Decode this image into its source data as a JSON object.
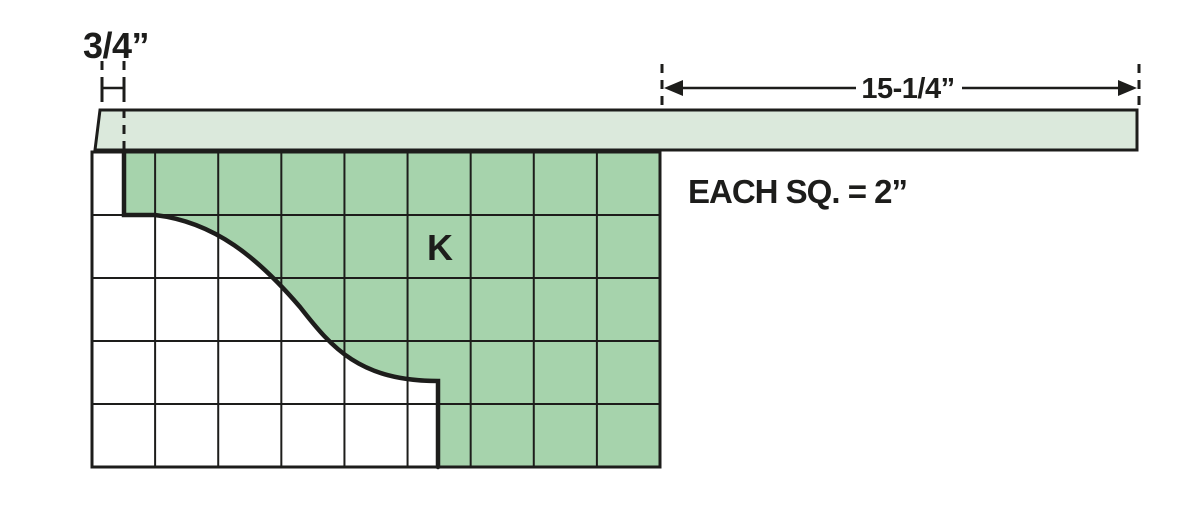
{
  "diagram": {
    "labels": {
      "offset_dim": "3/4”",
      "length_dim": "15-1/4”",
      "scale_note": "EACH SQ. = 2”",
      "piece": "K"
    },
    "grid": {
      "cols": 9,
      "rows": 5
    },
    "colors": {
      "rail_fill": "#dbe9dc",
      "piece_fill": "#a6d3ac",
      "line": "#1d1d1b",
      "background": "#ffffff"
    }
  }
}
